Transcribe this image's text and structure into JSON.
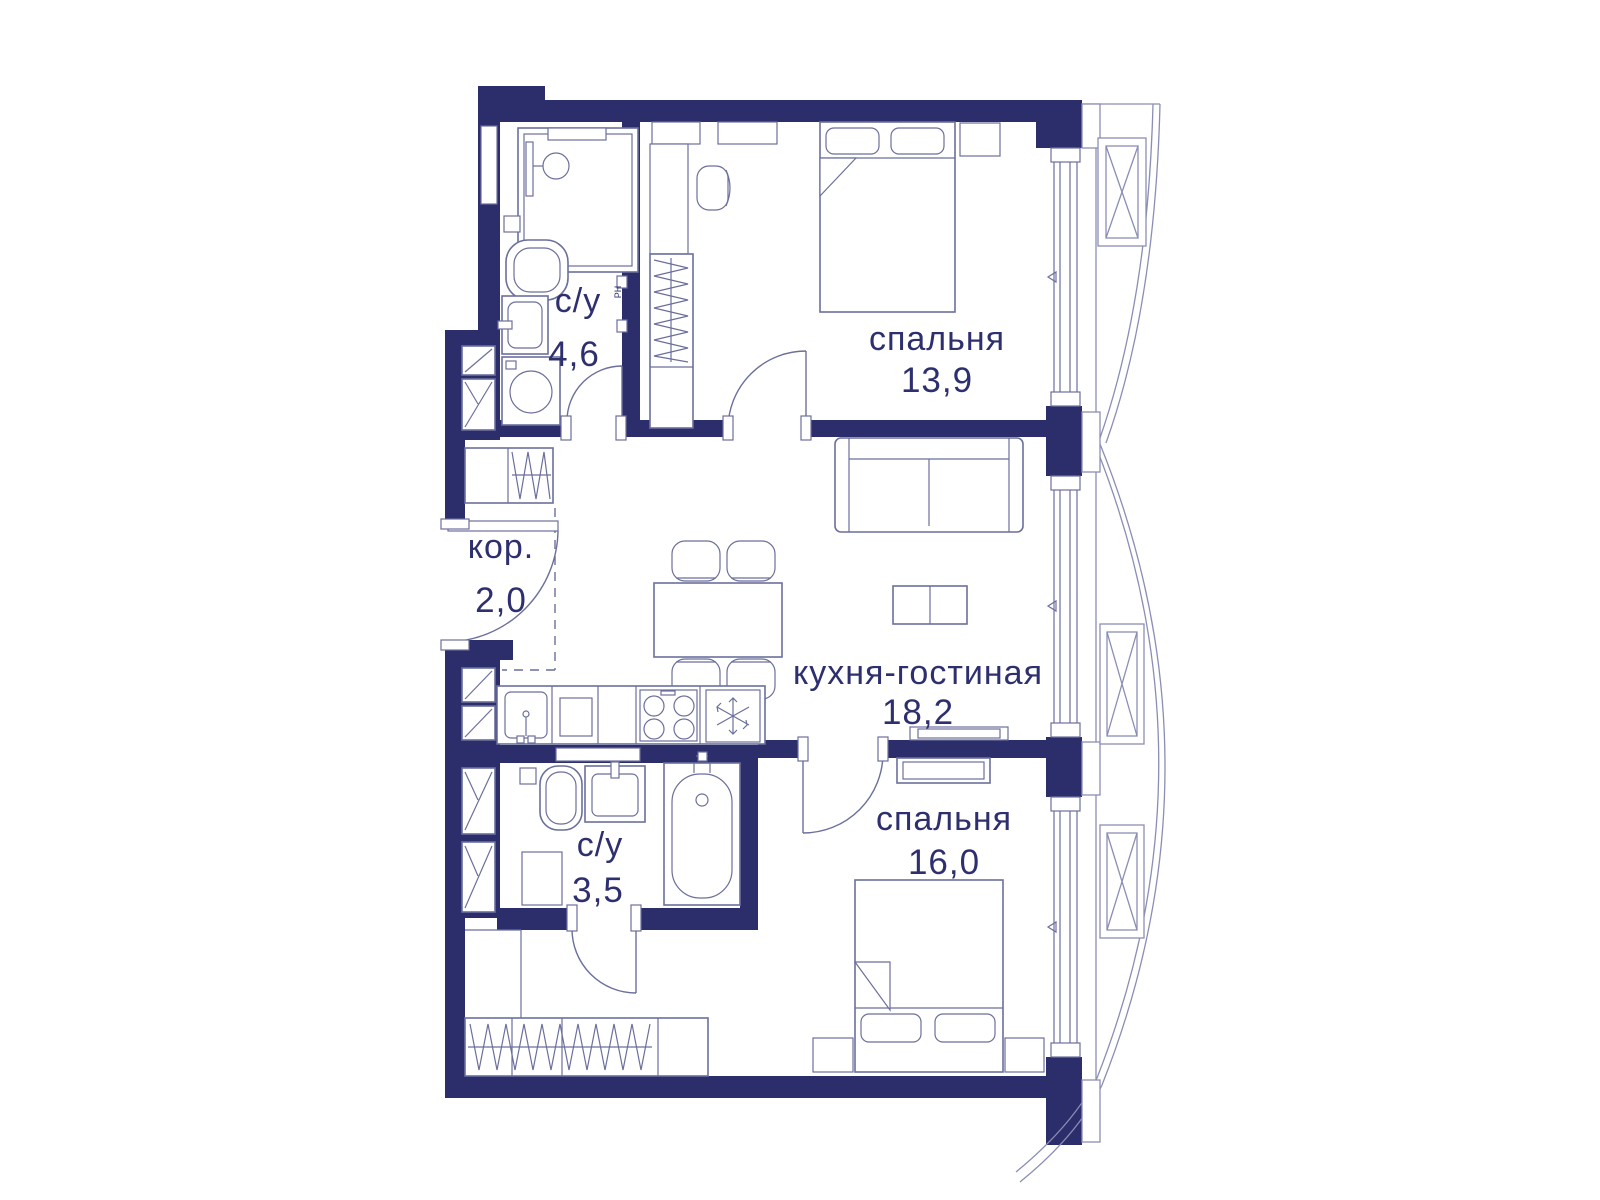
{
  "floor_plan": {
    "type": "apartment-floor-plan-2-bedrooms",
    "rooms": [
      {
        "key": "bathroom-1",
        "label": "с/у",
        "area": "4,6"
      },
      {
        "key": "bedroom-1",
        "label": "спальня",
        "area": "13,9"
      },
      {
        "key": "corridor",
        "label": "кор.",
        "area": "2,0"
      },
      {
        "key": "kitchen-living",
        "label": "кухня-гостиная",
        "area": "18,2"
      },
      {
        "key": "bathroom-2",
        "label": "с/у",
        "area": "3,5"
      },
      {
        "key": "bedroom-2",
        "label": "спальня",
        "area": "16,0"
      }
    ],
    "wall_tag": "РН",
    "colors": {
      "wall": "#2c2e6b",
      "line": "#6b6f9c",
      "line_light": "#8a8eb4",
      "text": "#2d2f6e",
      "background": "#ffffff"
    }
  }
}
